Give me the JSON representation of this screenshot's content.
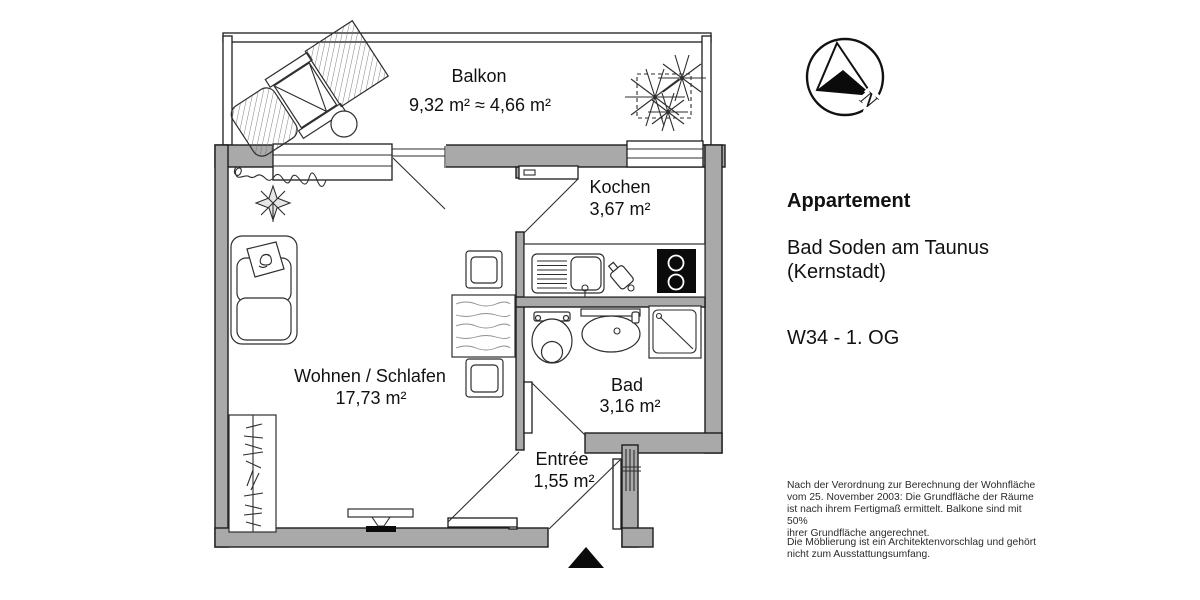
{
  "colors": {
    "wall": "#a9a9a9",
    "line": "#1c1c1c",
    "text": "#111111"
  },
  "rooms": {
    "balkon": {
      "name": "Balkon",
      "area": "9,32 m²  ≈  4,66 m²"
    },
    "kochen": {
      "name": "Kochen",
      "area": "3,67 m²"
    },
    "wohnen": {
      "name": "Wohnen / Schlafen",
      "area": "17,73 m²"
    },
    "bad": {
      "name": "Bad",
      "area": "3,16 m²"
    },
    "entree": {
      "name": "Entrée",
      "area": "1,55 m²"
    }
  },
  "compass": {
    "north": "N"
  },
  "info": {
    "title": "Appartement",
    "location": [
      "Bad Soden am Taunus",
      "(Kernstadt)"
    ],
    "unit": "W34 - 1. OG",
    "note1": [
      "Nach der Verordnung zur Berechnung der Wohnfläche",
      "vom 25. November 2003: Die Grundfläche der Räume",
      "ist nach ihrem Fertigmaß ermittelt. Balkone sind mit 50%",
      "ihrer Grundfläche angerechnet."
    ],
    "note2": [
      "Die Möblierung ist ein Architektenvorschlag und gehört",
      "nicht zum Ausstattungsumfang."
    ]
  }
}
